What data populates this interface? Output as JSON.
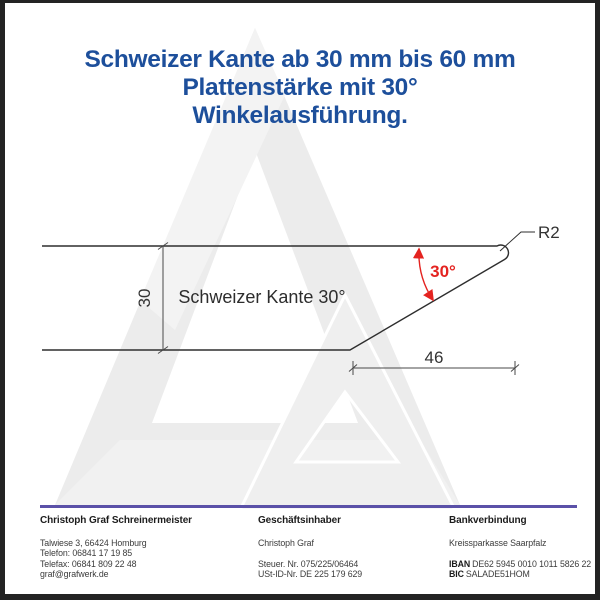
{
  "title": {
    "line1": "Schweizer Kante ab 30 mm bis 60 mm",
    "line2": "Plattenstärke mit 30°",
    "line3": "Winkelausführung."
  },
  "diagram": {
    "profile_label": "Schweizer Kante 30°",
    "thickness_dim": "30",
    "angle_label": "30°",
    "chamfer_width_dim": "46",
    "radius_label": "R2",
    "colors": {
      "profile_line": "#2e2e2e",
      "dimension_line": "#4a4a4a",
      "angle_red": "#e42320",
      "title_blue": "#1d4f9b",
      "watermark_gray": "#ececec",
      "footer_rule_purple": "#5b51a8"
    }
  },
  "footer": {
    "columns": [
      {
        "heading": "Christoph Graf Schreinermeister",
        "lines": [
          "Talwiese 3, 66424 Homburg",
          "Telefon: 06841 17 19 85",
          "Telefax: 06841 809 22 48",
          "graf@grafwerk.de"
        ]
      },
      {
        "heading": "Geschäftsinhaber",
        "lines": [
          "Christoph Graf",
          "",
          "Steuer. Nr. 075/225/06464",
          "USt-ID-Nr. DE 225 179 629"
        ]
      },
      {
        "heading": "Bankverbindung",
        "lines": [
          "Kreissparkasse Saarpfalz",
          ""
        ],
        "iban_label": "IBAN",
        "iban_value": "DE62 5945 0010 1011 5826 22",
        "bic_label": "BIC",
        "bic_value": "SALADE51HOM"
      }
    ]
  }
}
